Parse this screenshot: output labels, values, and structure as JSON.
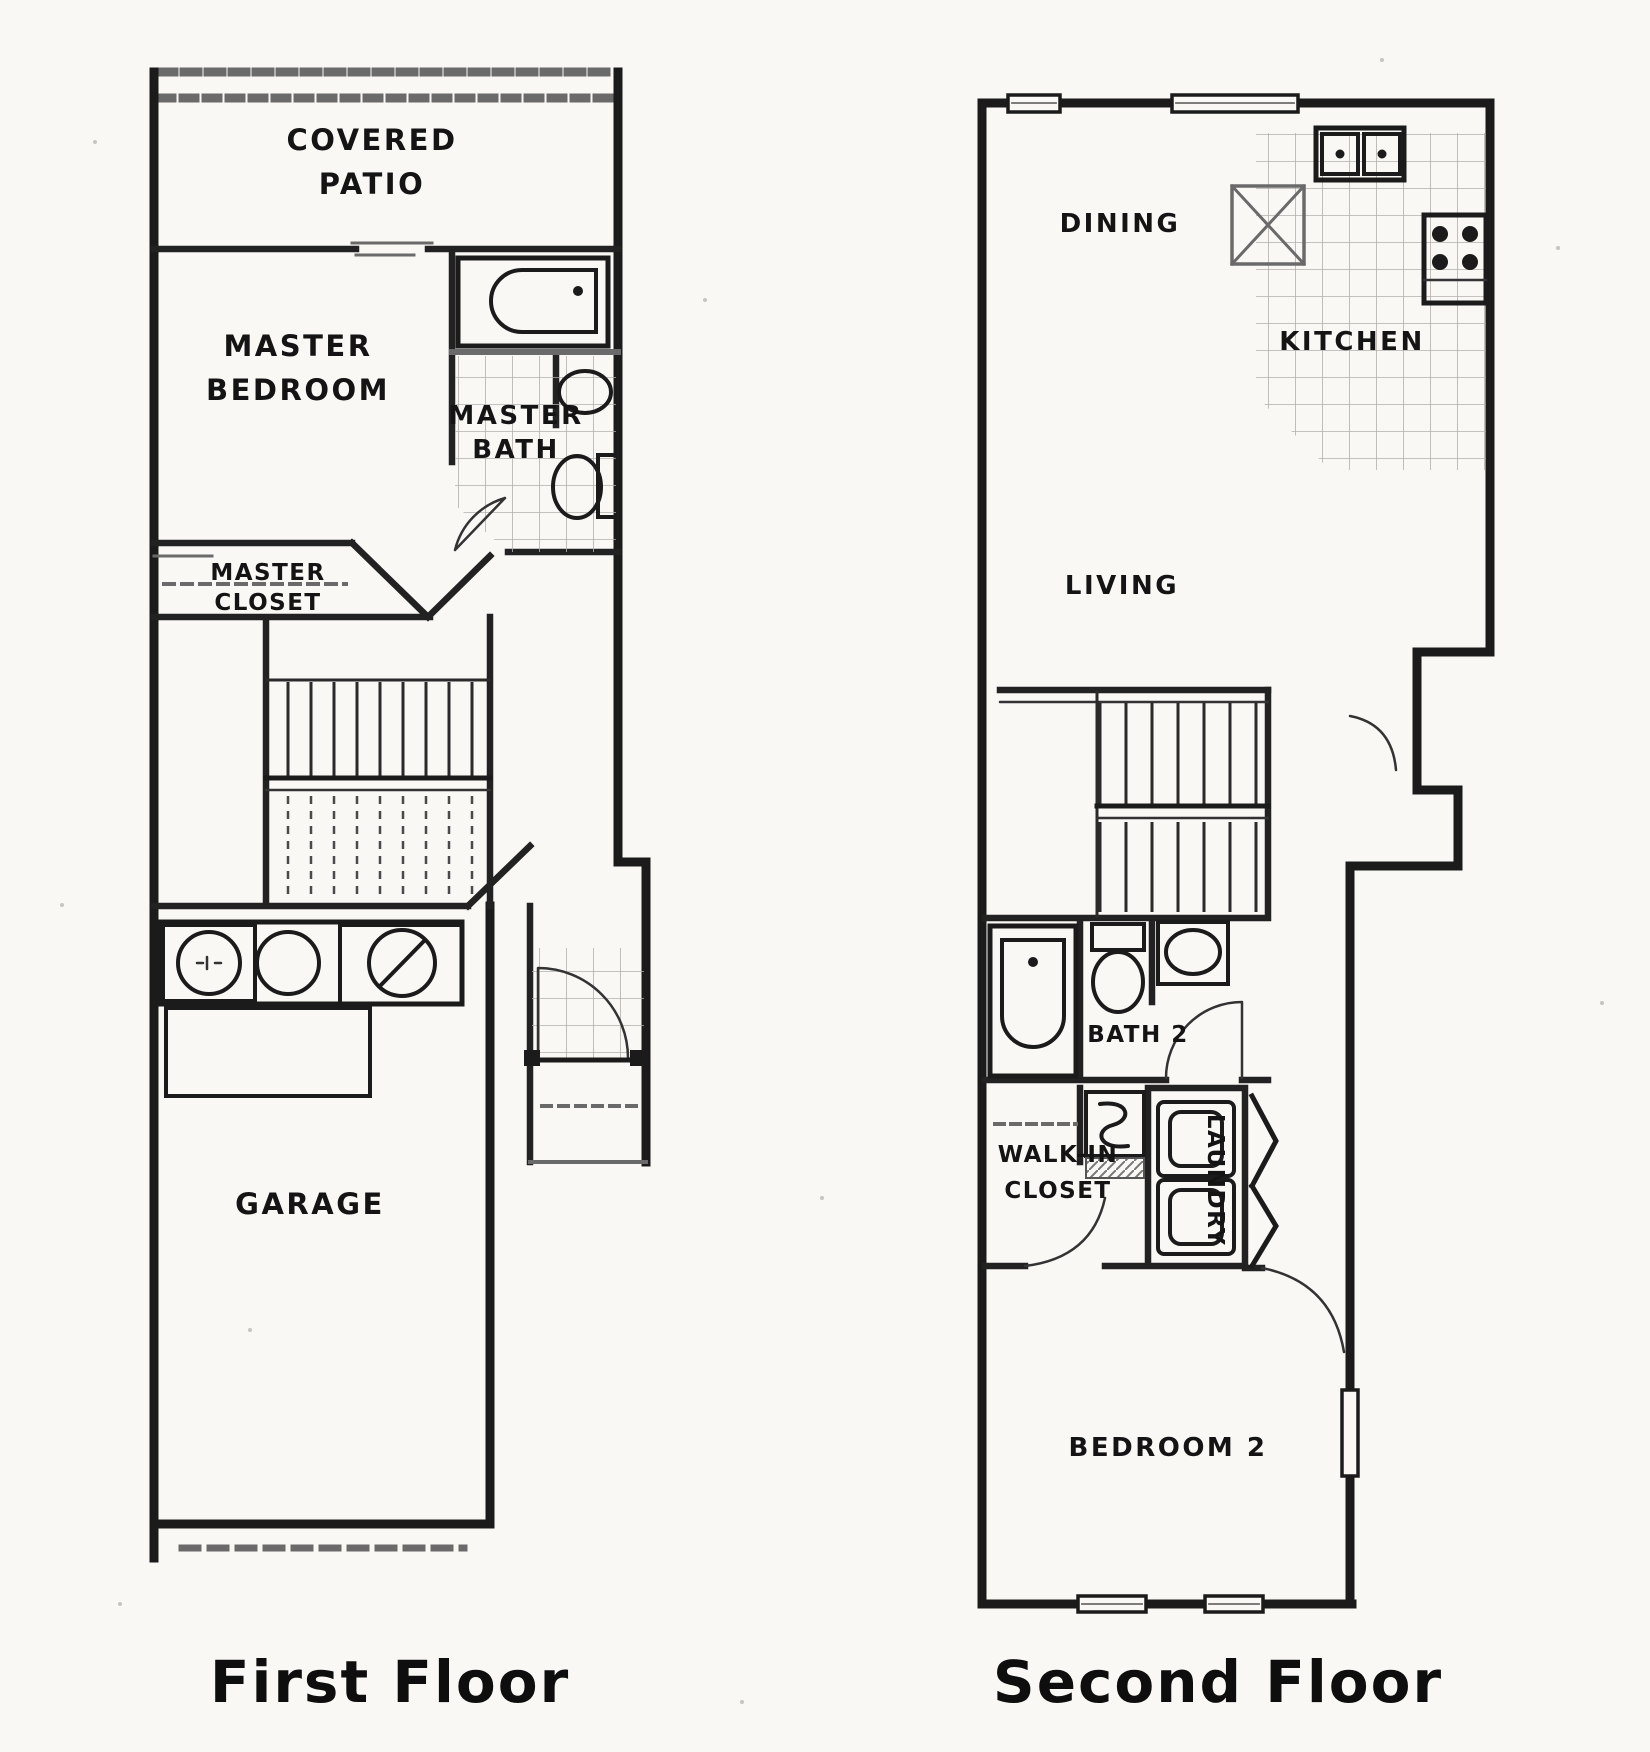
{
  "colors": {
    "paper": "#f9f8f5",
    "ink": "#1b1b1b",
    "tile_gray": "#b3b0ab",
    "detail_gray": "#6a6a6a"
  },
  "first_floor": {
    "title": "First Floor",
    "rooms": {
      "covered_patio": [
        "COVERED",
        "PATIO"
      ],
      "master_bedroom": [
        "MASTER",
        "BEDROOM"
      ],
      "master_bath": [
        "MASTER",
        "BATH"
      ],
      "master_closet": [
        "MASTER",
        "CLOSET"
      ],
      "garage": [
        "GARAGE"
      ]
    },
    "fixture_icons": [
      "bathtub-icon",
      "vanity-sink-icon",
      "toilet-icon",
      "water-heater-icon",
      "washer-icon",
      "dryer-icon",
      "stairs-icon",
      "garage-door-dashed",
      "entry-door-arc-icon"
    ]
  },
  "second_floor": {
    "title": "Second Floor",
    "rooms": {
      "dining": [
        "DINING"
      ],
      "kitchen": [
        "KITCHEN"
      ],
      "living": [
        "LIVING"
      ],
      "bath_2": [
        "BATH 2"
      ],
      "walk_in_closet": [
        "WALK-IN",
        "CLOSET"
      ],
      "laundry": [
        "LAUNDRY"
      ],
      "bedroom_2": [
        "BEDROOM 2"
      ]
    },
    "fixture_icons": [
      "double-kitchen-sink-icon",
      "stove-icon",
      "pantry-x-icon",
      "bathtub-icon",
      "toilet-icon",
      "sink-icon",
      "washer-dryer-stack-icon",
      "bifold-door-icon",
      "closet-rod-dashed",
      "stairs-icon",
      "window-icon"
    ]
  }
}
